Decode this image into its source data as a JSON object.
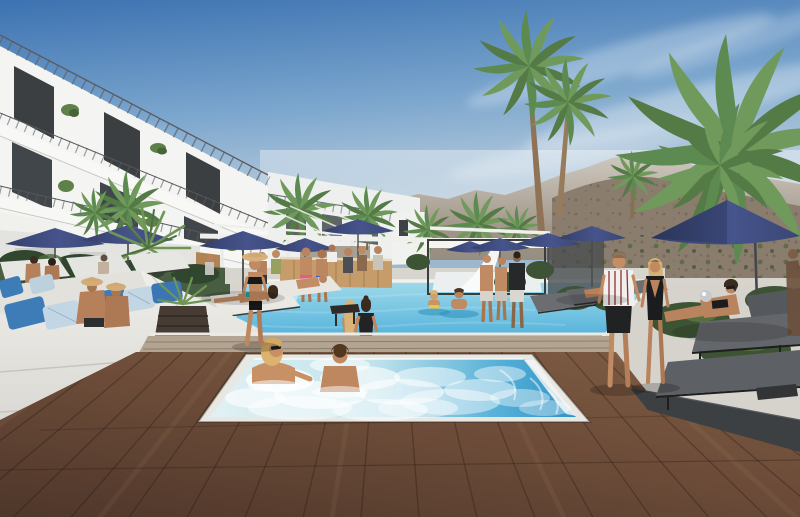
{
  "meta": {
    "description": "Sunny desert-resort pool rendering: white modern hotel with open balconies on the left, hazy rocky mountains and tall fan palms behind, navy patio umbrellas and loungers flanking a turquoise pool, a bubbling spa tub set into a dark wood deck in the foreground, and guests walking, lounging and swimming.",
    "width": 800,
    "height": 517
  },
  "palette": {
    "sky_top": "#4a7fba",
    "sky_horizon": "#ccd9e2",
    "mountain_far": "#a79d90",
    "mountain_near": "#8a7d6d",
    "building_white": "#f4f4f2",
    "window_dark": "#3b3f42",
    "umbrella_navy": "#3f4a7c",
    "pool_far": "#9fd9ea",
    "pool_near": "#4fb0da",
    "spa_blue": "#2f93c4",
    "spa_foam": "#e2f1f4",
    "wood_deck": "#6b4b38",
    "wood_strip": "#b3a492",
    "concrete": "#d6d3cc",
    "walkway_dark": "#3c4043",
    "cushion_white": "#e9e7e2",
    "pillow_blue": "#3e7cb8",
    "palm_green": "#6f9a5c",
    "hedge_green": "#31462e",
    "skin_tan": "#c08b63",
    "hair_blonde": "#d9b478",
    "bar_wood": "#c59c6a"
  },
  "scene": {
    "sky": {
      "clouds": "wispy white streaks upper right"
    },
    "building": {
      "type": "modern white hotel",
      "visible_floors": 3,
      "features": [
        "open balconies",
        "dark glass doors",
        "balcony plants",
        "roof railing"
      ]
    },
    "vegetation": {
      "tall_fan_palms": 2,
      "bushy_palm_right": 1,
      "background_palms": 8,
      "yucca_left": 1,
      "hedges_and_planters": true
    },
    "umbrellas": {
      "count": 10,
      "color_name": "navy"
    },
    "pool": {
      "shape": "rectangular",
      "people_in_water": 2,
      "people_seated_on_edge": 2
    },
    "spa_tub": {
      "state": "bubbling",
      "bathers": 2
    },
    "deck": {
      "foreground": "dark wood planks",
      "mid": "light concrete",
      "right": "dark stone band"
    },
    "furniture": {
      "left": "white daybeds with blue pillows",
      "right": "grey sling loungers",
      "bar": "wood pool bar with standing guests"
    },
    "people": [
      {
        "label": "woman in black bikini and straw hat walking poolside",
        "area": "center-left"
      },
      {
        "label": "couple walking away - striped shirt man, black-swimsuit woman",
        "area": "right"
      },
      {
        "label": "two bathers in the bubbling spa tub",
        "area": "foreground"
      },
      {
        "label": "two swimmers in the main pool",
        "area": "center"
      },
      {
        "label": "two women seated on the pool edge",
        "area": "center"
      },
      {
        "label": "couple in straw hats on the white daybed",
        "area": "left"
      },
      {
        "label": "woman reclining on a lounger holding a silver ball",
        "area": "right"
      },
      {
        "label": "guests standing at the pool bar",
        "area": "background"
      },
      {
        "label": "three guests at the far pool corner",
        "area": "center-right"
      }
    ]
  }
}
